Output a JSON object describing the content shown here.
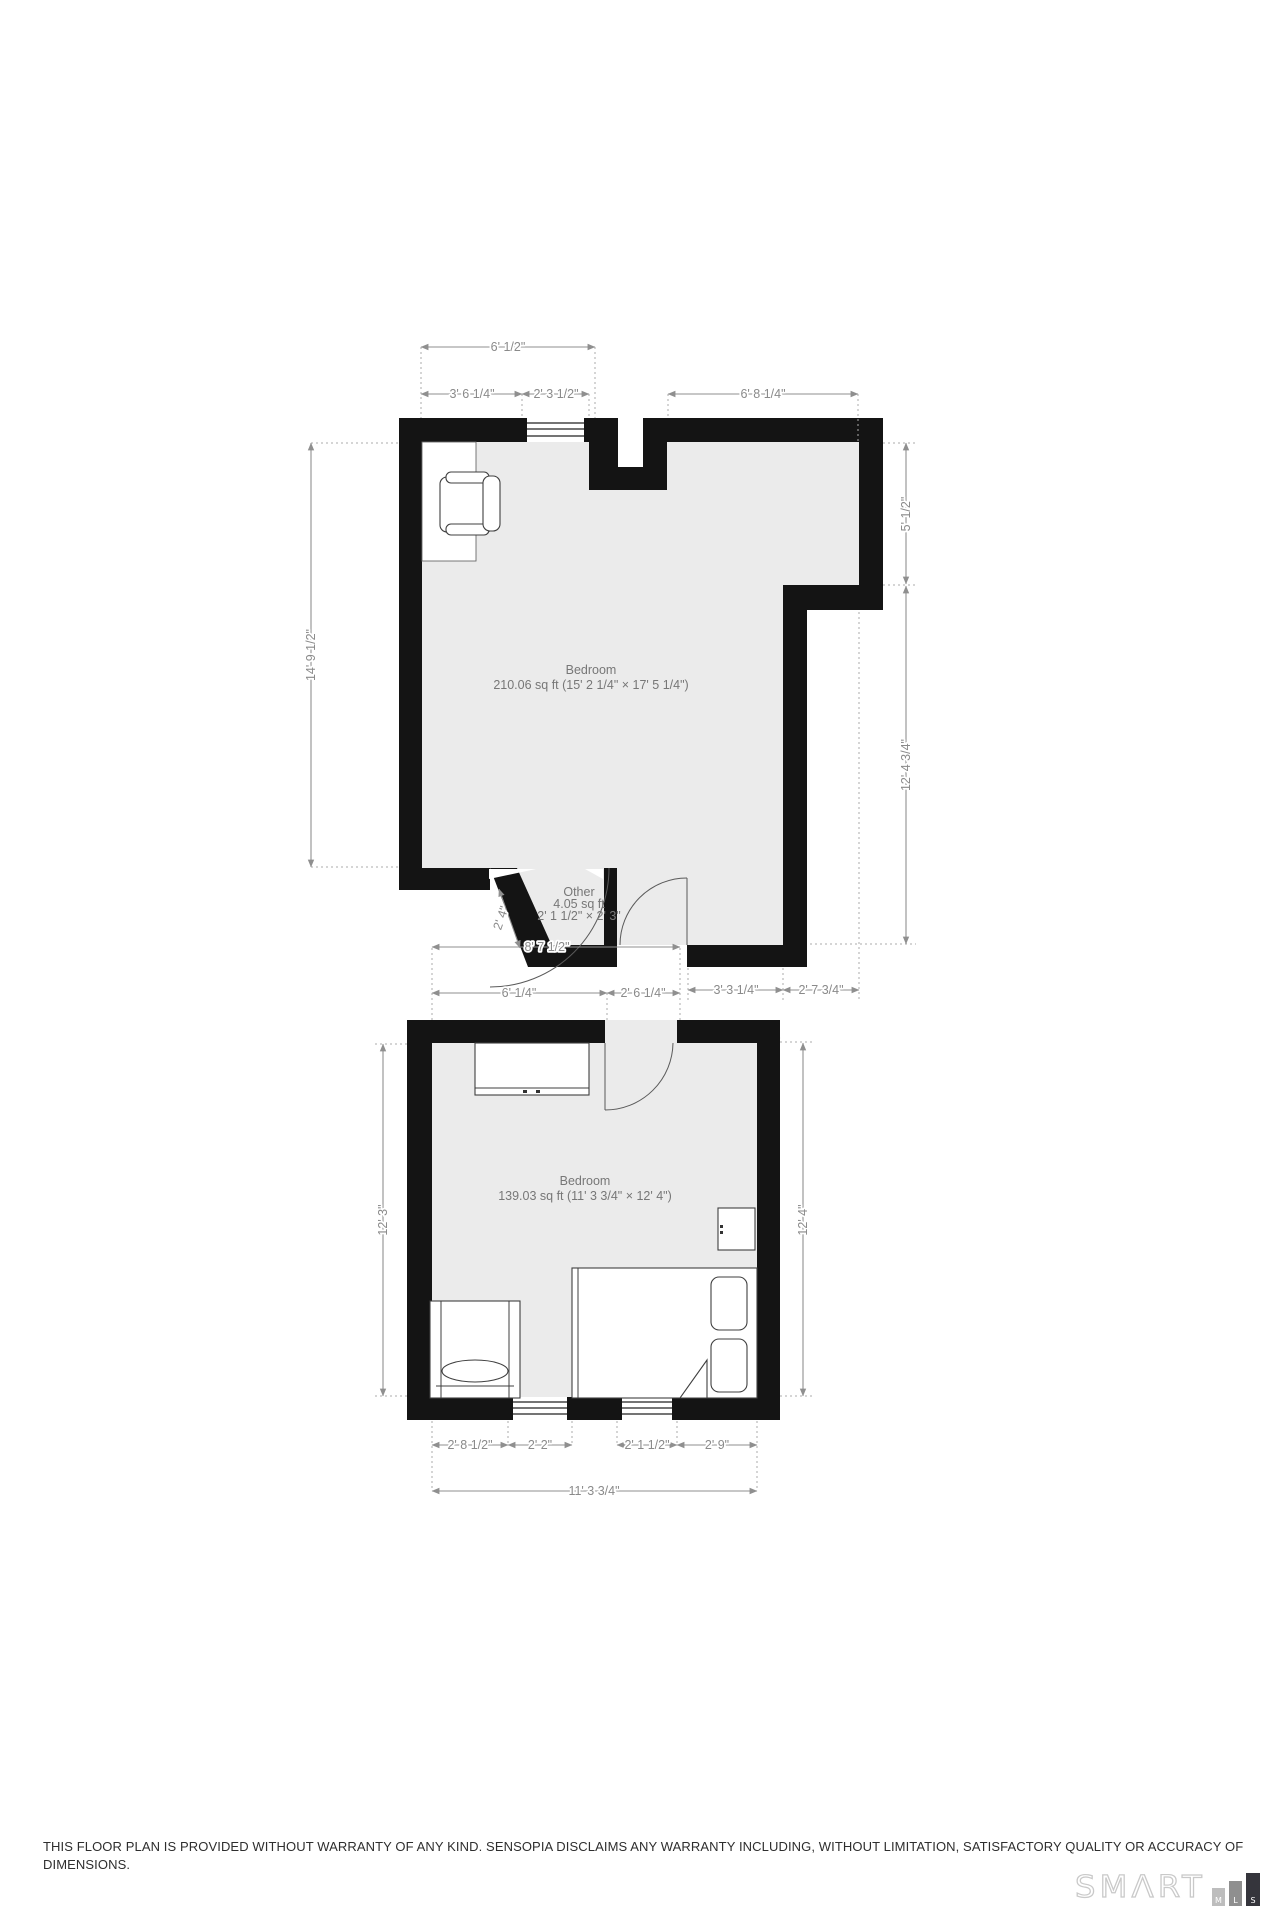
{
  "colors": {
    "wall": "#141414",
    "floor": "#ebebeb",
    "dimension_gray": "#8a8a8a",
    "logo_block_m": "#bdbdbd",
    "logo_block_l": "#8f8f8f",
    "logo_block_s": "#35353c"
  },
  "upper_room": {
    "name": "Bedroom",
    "area": "210.06 sq ft (15' 2 1/4\" × 17' 5 1/4\")"
  },
  "other_room": {
    "name": "Other",
    "area": "4.05 sq ft",
    "size": "2' 1 1/2\" × 2' 3\""
  },
  "lower_room": {
    "name": "Bedroom",
    "area": "139.03 sq ft (11' 3 3/4\" × 12' 4\")"
  },
  "dimensions": {
    "upper": {
      "top_total": "6' 1/2\"",
      "top_left": "3' 6 1/4\"",
      "top_window": "2' 3 1/2\"",
      "top_right": "6' 8 1/4\"",
      "left_height": "14' 9 1/2\"",
      "right_upper": "5' 1/2\"",
      "right_lower": "12' 4 3/4\"",
      "door_width": "2' 4\"",
      "bottom_span": "8' 7 1/2\"",
      "bottom_left": "6' 1/4\"",
      "bottom_door": "2' 6 1/4\"",
      "bottom_right_a": "3' 3 1/4\"",
      "bottom_right_b": "2' 7 3/4\"",
      "interior_top": "5' 10\""
    },
    "lower": {
      "left_height": "12' 3\"",
      "right_height": "12' 4\"",
      "bottom_a": "2' 8 1/2\"",
      "bottom_b": "2' 2\"",
      "bottom_c": "2' 1 1/2\"",
      "bottom_d": "2' 9\"",
      "bottom_total": "11' 3 3/4\""
    }
  },
  "footer": {
    "disclaimer_line1": "THIS FLOOR PLAN IS PROVIDED WITHOUT WARRANTY OF ANY KIND. SENSOPIA DISCLAIMS ANY WARRANTY INCLUDING, WITHOUT LIMITATION, SATISFACTORY QUALITY OR ACCURACY OF",
    "disclaimer_line2": "DIMENSIONS.",
    "logo_text": "SMΛRT",
    "logo_blocks": [
      "M",
      "L",
      "S"
    ]
  }
}
